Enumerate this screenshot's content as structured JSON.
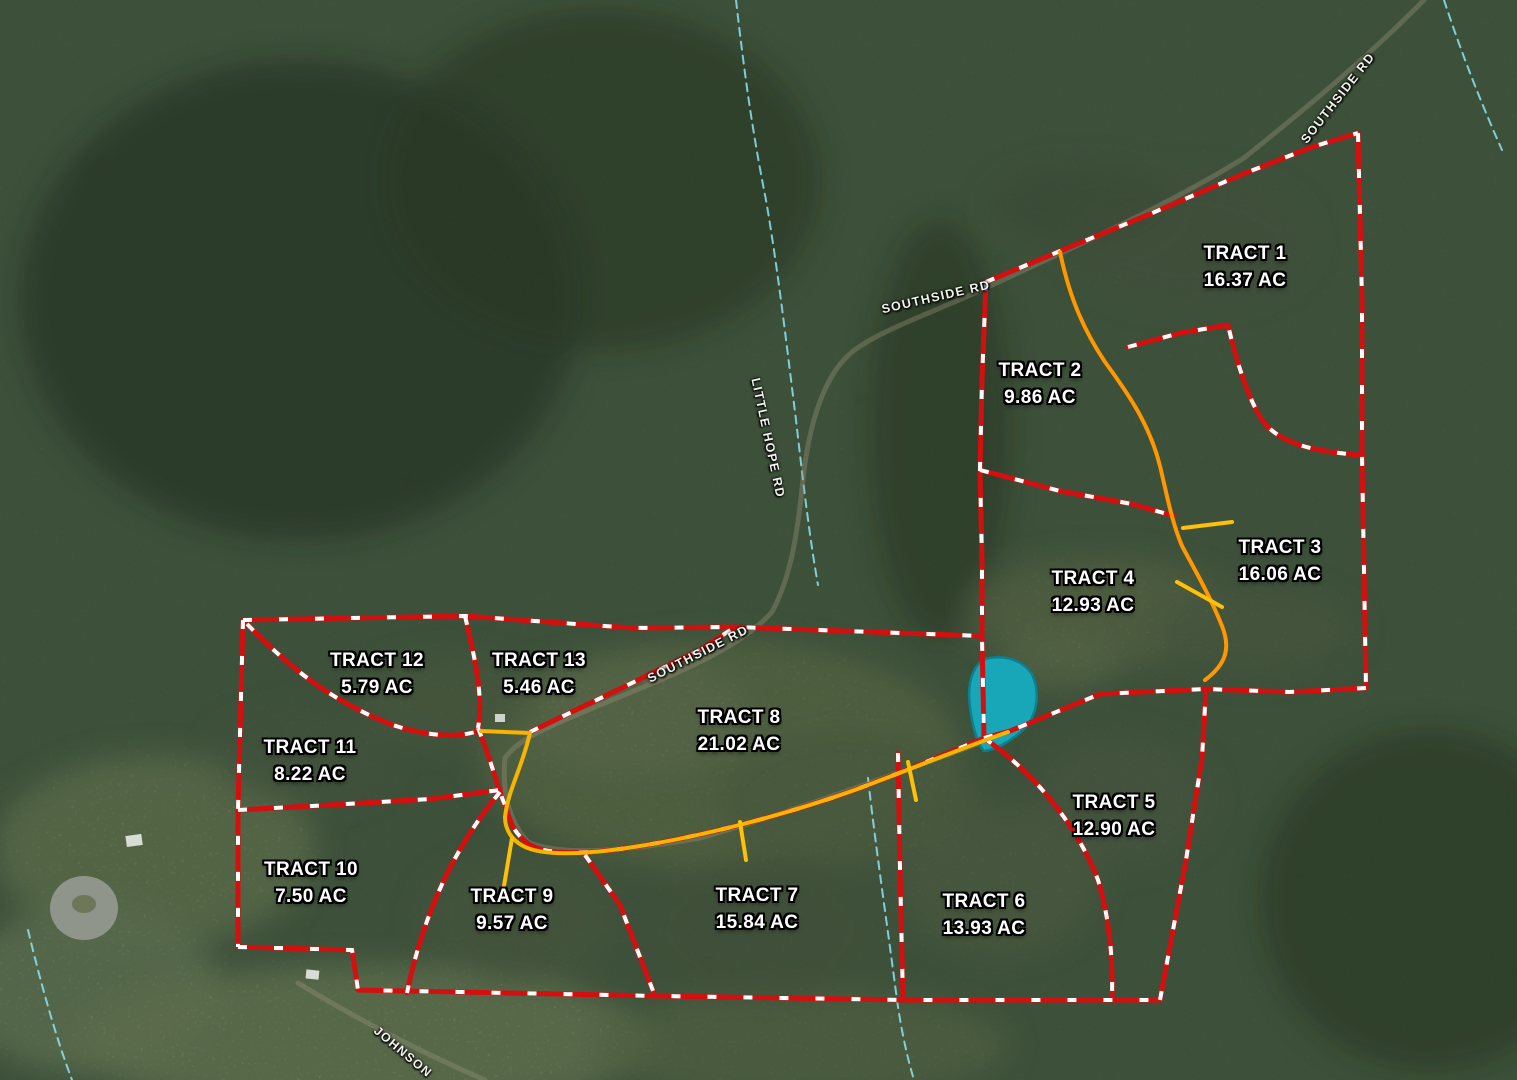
{
  "map": {
    "type": "aerial-parcel-map",
    "colors": {
      "boundary": "#d40f0f",
      "boundary_dash": "#ffffff",
      "water": "#18a7b8",
      "water_edge": "#0d7f8e",
      "creek": "#8ee4f4",
      "road_surface": "#9a9178",
      "label_text": "#ffffff"
    },
    "tracts": [
      {
        "name": "TRACT 1",
        "acreage": "16.37 AC",
        "x": 1245,
        "y": 267
      },
      {
        "name": "TRACT 2",
        "acreage": "9.86 AC",
        "x": 1040,
        "y": 384
      },
      {
        "name": "TRACT 3",
        "acreage": "16.06 AC",
        "x": 1280,
        "y": 561
      },
      {
        "name": "TRACT 4",
        "acreage": "12.93 AC",
        "x": 1093,
        "y": 592
      },
      {
        "name": "TRACT 5",
        "acreage": "12.90 AC",
        "x": 1114,
        "y": 816
      },
      {
        "name": "TRACT 6",
        "acreage": "13.93 AC",
        "x": 984,
        "y": 915
      },
      {
        "name": "TRACT 7",
        "acreage": "15.84 AC",
        "x": 757,
        "y": 909
      },
      {
        "name": "TRACT 8",
        "acreage": "21.02 AC",
        "x": 739,
        "y": 731
      },
      {
        "name": "TRACT 9",
        "acreage": "9.57 AC",
        "x": 512,
        "y": 910
      },
      {
        "name": "TRACT 10",
        "acreage": "7.50 AC",
        "x": 311,
        "y": 883
      },
      {
        "name": "TRACT 11",
        "acreage": "8.22 AC",
        "x": 310,
        "y": 761
      },
      {
        "name": "TRACT 12",
        "acreage": "5.79 AC",
        "x": 377,
        "y": 674
      },
      {
        "name": "TRACT 13",
        "acreage": "5.46 AC",
        "x": 539,
        "y": 674
      }
    ],
    "road_labels": [
      {
        "text": "SOUTHSIDE RD",
        "x": 1338,
        "y": 98,
        "rotation": -52
      },
      {
        "text": "SOUTHSIDE RD",
        "x": 936,
        "y": 297,
        "rotation": -13
      },
      {
        "text": "SOUTHSIDE RD",
        "x": 698,
        "y": 654,
        "rotation": -27
      },
      {
        "text": "LITTLE HOPE RD",
        "x": 768,
        "y": 438,
        "rotation": 78
      },
      {
        "text": "JOHNSON",
        "x": 403,
        "y": 1052,
        "rotation": 40
      }
    ],
    "boundaries": [
      {
        "name": "outer-northeast-along-road",
        "d": "M986,282 L1065,249 L1150,214 L1243,174 L1312,147 L1358,133"
      },
      {
        "name": "outer-east-edge",
        "d": "M1358,133 L1362,300 L1362,455 L1366,688"
      },
      {
        "name": "tract3-south-line",
        "d": "M1366,688 L1290,692 L1206,689"
      },
      {
        "name": "cluster-west-edge",
        "d": "M986,282 L982,380 L980,470 L982,560 L982,637 L984,738"
      },
      {
        "name": "tract2-tract4-divider",
        "d": "M980,470 L1060,491 L1132,504 L1174,516"
      },
      {
        "name": "tract1-tract3-divider",
        "d": "M1128,347 L1180,333 L1228,325 C1236,360 1248,398 1262,420 C1278,442 1310,452 1363,455"
      },
      {
        "name": "west-block-north-line",
        "d": "M243,620 L465,616 L632,628 L735,627 L982,636"
      },
      {
        "name": "tract13-tract8-road-divider",
        "d": "M530,732 L607,695 L700,650 L735,627"
      },
      {
        "name": "west-block-west-edge",
        "d": "M243,620 L238,810 L238,947"
      },
      {
        "name": "south-boundary",
        "d": "M238,947 L352,950 L358,990 L660,996 L905,1000 L1160,1000"
      },
      {
        "name": "tract5-east-edge",
        "d": "M1160,1000 L1186,860 L1202,758 L1206,689"
      },
      {
        "name": "tract4-tract5-divider",
        "d": "M984,738 L1010,731 L1100,694 L1206,689"
      },
      {
        "name": "tract5-tract6-divider",
        "d": "M984,738 C1030,770 1075,820 1098,880 C1110,920 1113,960 1112,999"
      },
      {
        "name": "tract6-tract7-divider",
        "d": "M898,753 L900,870 L903,1000"
      },
      {
        "name": "tract8-south-road-boundary",
        "d": "M478,728 C492,762 498,790 505,805 C511,825 514,832 527,843 C542,854 575,855 620,849 C700,838 790,813 852,791 C906,771 960,748 984,738"
      },
      {
        "name": "tract11-tract12-divider",
        "d": "M247,624 C290,668 330,700 390,724 C430,738 462,737 478,731"
      },
      {
        "name": "tract12-tract13-divider",
        "d": "M465,616 C474,655 484,695 478,728"
      },
      {
        "name": "tract10-tract11-divider",
        "d": "M238,810 L330,805 L430,799 L500,790"
      },
      {
        "name": "tract9-tract10-divider",
        "d": "M500,792 C460,840 425,905 407,993"
      },
      {
        "name": "tract7-tract9-divider",
        "d": "M585,855 L620,905 L655,996"
      }
    ],
    "survey_lines": [
      {
        "name": "driveway-line-east",
        "color": "#ff9800",
        "d": "M1060,252 C1070,300 1085,332 1105,362 C1130,396 1150,426 1160,466 C1168,500 1172,522 1182,546 C1196,572 1210,596 1222,626 C1230,646 1228,663 1205,680"
      },
      {
        "name": "east-spur-upper",
        "color": "#ffc107",
        "d": "M1183,528 L1232,522"
      },
      {
        "name": "east-spur-lower",
        "color": "#ffc107",
        "d": "M1177,582 L1222,607"
      },
      {
        "name": "driveway-line-west",
        "color": "#f7b500",
        "d": "M481,731 L530,733 C522,768 508,790 505,817 C505,830 512,840 523,846 C540,855 575,855 620,849 C700,838 790,813 852,791 C906,771 962,748 1008,732"
      },
      {
        "name": "west-spur-a",
        "color": "#ffc107",
        "d": "M512,838 L503,892"
      },
      {
        "name": "west-spur-b",
        "color": "#ffc107",
        "d": "M740,822 L746,860"
      },
      {
        "name": "west-spur-c",
        "color": "#ffc107",
        "d": "M908,762 L916,800"
      }
    ],
    "creeks": [
      {
        "name": "creek-little-hope",
        "d": "M736,0 C744,70 752,130 766,200 C778,270 786,340 796,420 C804,490 810,540 818,585"
      },
      {
        "name": "creek-northeast",
        "d": "M1444,0 C1462,55 1482,105 1502,150"
      },
      {
        "name": "creek-south",
        "d": "M868,778 C876,850 888,930 897,1000 C902,1035 908,1060 914,1080"
      },
      {
        "name": "creek-southwest",
        "d": "M28,930 C40,980 55,1035 72,1080"
      }
    ],
    "road_paths": [
      {
        "name": "southside-rd",
        "d": "M1424,0 C1370,55 1310,105 1244,158 C1160,210 1062,252 988,287 C930,314 880,330 852,352 C828,372 812,410 804,470 C798,530 792,575 772,612 C740,648 680,672 612,700 C560,722 520,736 505,758 C502,790 508,820 528,842 C560,856 620,852 700,838 C790,813 900,772 1008,733"
      },
      {
        "name": "johnson-rd",
        "d": "M298,983 C350,1015 420,1052 485,1080"
      }
    ],
    "pond": {
      "name": "pond",
      "d": "M985,659 C1005,654 1022,660 1032,674 C1040,692 1038,712 1026,727 C1012,741 995,750 984,751 C976,742 970,718 969,695 C969,678 975,664 985,659 Z"
    }
  }
}
